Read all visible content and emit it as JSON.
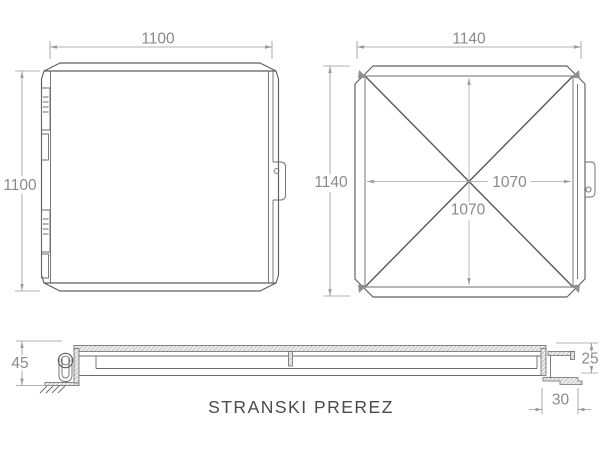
{
  "document": {
    "kind": "technical-drawing"
  },
  "colors": {
    "background": "#ffffff",
    "part_line": "#5f5f5f",
    "dim_line": "#9b9b9b",
    "dim_text": "#8a8a8a",
    "title_text": "#4a4a4a",
    "hatch": "#909090"
  },
  "views": {
    "front": {
      "width_dim": "1100",
      "height_dim": "1100"
    },
    "top": {
      "width_dim": "1140",
      "height_dim": "1140",
      "inner_width_dim": "1070",
      "inner_height_dim": "1070"
    },
    "section": {
      "title": "STRANSKI PREREZ",
      "height_dim": "45",
      "edge_height_dim": "25",
      "flange_width_dim": "30"
    }
  }
}
